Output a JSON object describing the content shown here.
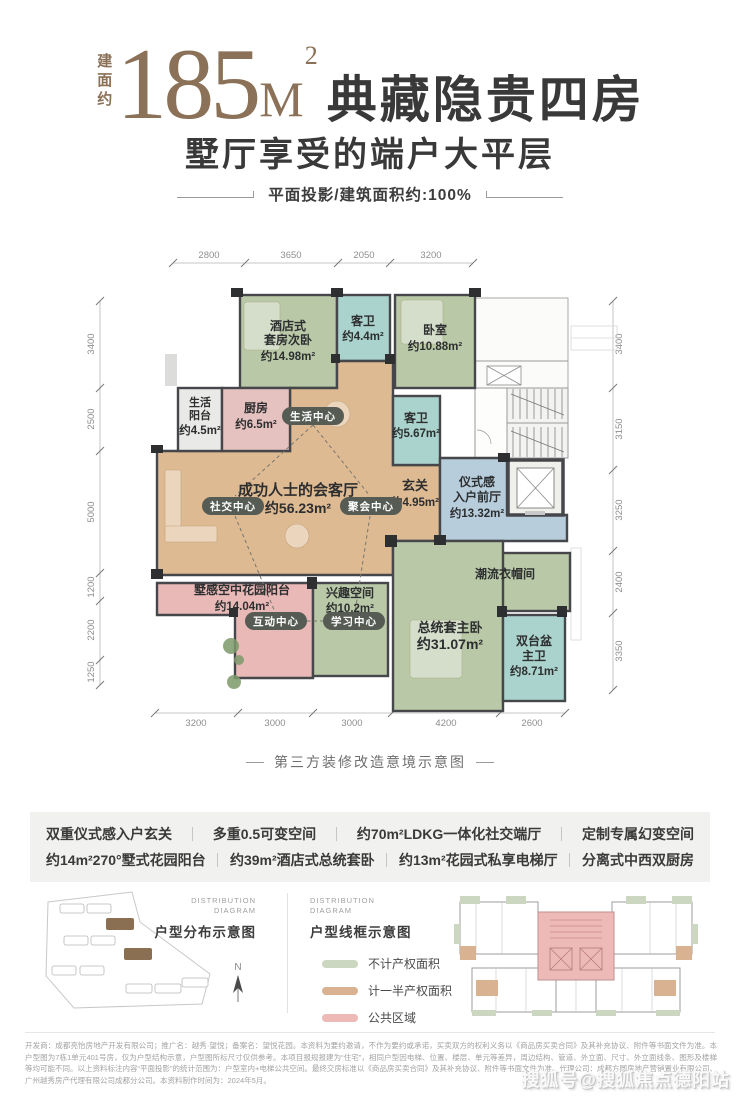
{
  "header": {
    "built_area_label": "建面约",
    "area_value": "185",
    "area_unit": "M",
    "area_exponent": "2",
    "headline": "典藏隐贵四房",
    "subheadline": "墅厅享受的端户大平层",
    "tagline": "平面投影/建筑面积约:100%"
  },
  "floorplan": {
    "caption": "第三方装修改造意境示意图",
    "palette": {
      "bedroom_green": "#b9c9a7",
      "bath_teal": "#a9d3cc",
      "living_tan": "#deba92",
      "balcony_pink": "#e9b9b7",
      "kitchen_pink": "#e5c1bf",
      "foyer_blue": "#b7cddc",
      "utility_gray": "#e9e9e7",
      "badge_bg": "#565b54"
    },
    "dims_top": [
      "2800",
      "3650",
      "2050",
      "3200"
    ],
    "dims_left": [
      "3400",
      "2500",
      "5000",
      "1200",
      "2200",
      "1250"
    ],
    "dims_right": [
      "3400",
      "3150",
      "3250",
      "2400",
      "3350"
    ],
    "dims_bottom": [
      "3200",
      "3000",
      "3000",
      "4200",
      "2600"
    ],
    "rooms": {
      "hotel_suite": {
        "name1": "酒店式",
        "name2": "套房次卧",
        "area": "约14.98m²"
      },
      "guest_bath_top": {
        "name": "客卫",
        "area": "约4.4m²"
      },
      "bedroom": {
        "name": "卧室",
        "area": "约10.88m²"
      },
      "life_balcony": {
        "name1": "生活",
        "name2": "阳台",
        "area": "约4.5m²"
      },
      "kitchen": {
        "name": "厨房",
        "area": "约6.5m²"
      },
      "living": {
        "name": "成功人士的会客厅",
        "area": "约56.23m²"
      },
      "guest_bath_mid": {
        "name": "客卫",
        "area": "约5.67m²"
      },
      "foyer": {
        "name": "玄关",
        "area": "约4.95m²"
      },
      "entry_hall": {
        "name1": "仪式感",
        "name2": "入户前厅",
        "area": "约13.32m²"
      },
      "cloakroom": {
        "name": "潮流衣帽间"
      },
      "sky_garden": {
        "name": "墅感空中花园阳台",
        "area": "约14.04m²"
      },
      "interest_space": {
        "name": "兴趣空间",
        "area": "约10.2m²"
      },
      "master_bedroom": {
        "name": "总统套主卧",
        "area": "约31.07m²"
      },
      "master_bath": {
        "name1": "双台盆",
        "name2": "主卫",
        "area": "约8.71m²"
      }
    },
    "badges": {
      "life": "生活中心",
      "social": "社交中心",
      "party": "聚会中心",
      "interact": "互动中心",
      "study": "学习中心"
    }
  },
  "features": {
    "row1": [
      "双重仪式感入户玄关",
      "多重0.5可变空间",
      "约70m²LDKG一体化社交端厅",
      "定制专属幻变空间"
    ],
    "row2": [
      "约14m²270°墅式花园阳台",
      "约39m²酒店式总统套卧",
      "约13m²花园式私享电梯厅",
      "分离式中西双厨房"
    ]
  },
  "diagrams": {
    "distribution": {
      "label_en1": "DISTRIBUTION",
      "label_en2": "DIAGRAM",
      "label_cn": "户型分布示意图",
      "compass": "N",
      "highlight_color": "#8a6f52"
    },
    "wireframe": {
      "label_en1": "DISTRIBUTION",
      "label_en2": "DIAGRAM",
      "label_cn": "户型线框示意图"
    },
    "legend": [
      {
        "label": "不计产权面积",
        "color": "#ccd7c2"
      },
      {
        "label": "计一半产权面积",
        "color": "#d8b291"
      },
      {
        "label": "公共区域",
        "color": "#edbab8"
      }
    ]
  },
  "footer": {
    "disclaimer": "开发商：成都亮怡房地产开发有限公司；推广名：越秀·望悦；备案名：望悦花园。本资料为要约邀请，不作为要约或承诺，买卖双方的权利义务以《商品房买卖合同》及其补充协议、附件等书面文件为准。本户型图为7栋1单元401号房，仅为户型结构示意，户型图所标尺寸仅供参考。本项目报规报建为“住宅”，相同户型因电梯、位置、楼层、单元等差异，周边结构、管道、外立面、尺寸、外立面线条、图形及楼梯等均可能不同。以上资料标注内容“平面投影”的统计范围为：户型室内+电梯公共空间。最终交房标准以《商品房买卖合同》及其补充协议、附件等书面文件为准。代理公司：成都方圆房地产营销置业有限公司、广州越秀房产代理有限公司成都分公司。本资料制作时间为：2024年5月。",
    "watermark": "搜狐号@搜狐焦点德阳站"
  }
}
